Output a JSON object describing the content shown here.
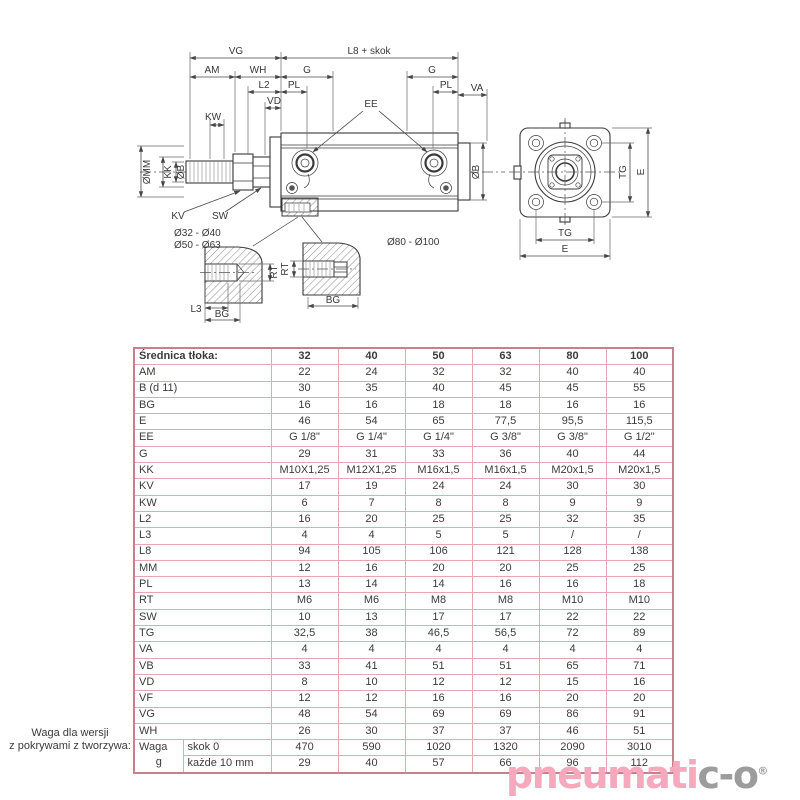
{
  "drawing": {
    "top_dims": {
      "vg": "VG",
      "l8": "L8 + skok",
      "am": "AM",
      "wh": "WH",
      "g_front": "G",
      "g_rear": "G",
      "l2": "L2",
      "pl_front": "PL",
      "pl_rear": "PL",
      "va": "VA",
      "vd": "VD",
      "kw": "KW",
      "ee": "EE"
    },
    "rod_dims": {
      "omm": "ØMM",
      "kk": "KK",
      "ob": "ØB",
      "kv": "KV",
      "sw": "SW"
    },
    "body_dim_ob": "ØB",
    "ranges": {
      "small": "Ø32 - Ø40",
      "mid": "Ø50 - Ø63",
      "large": "Ø80 - Ø100"
    },
    "details": {
      "rt_left": "RT",
      "rt_right": "RT",
      "l3": "L3",
      "bg_left": "BG",
      "bg_right": "BG"
    },
    "end_view": {
      "tg_right": "TG",
      "e_right": "E",
      "tg_bottom": "TG",
      "e_bottom": "E"
    }
  },
  "table": {
    "header_label": "Średnica tłoka:",
    "columns": [
      "32",
      "40",
      "50",
      "63",
      "80",
      "100"
    ],
    "rows": [
      {
        "label": "AM",
        "values": [
          "22",
          "24",
          "32",
          "32",
          "40",
          "40"
        ]
      },
      {
        "label": "B (d 11)",
        "values": [
          "30",
          "35",
          "40",
          "45",
          "45",
          "55"
        ]
      },
      {
        "label": "BG",
        "values": [
          "16",
          "16",
          "18",
          "18",
          "16",
          "16"
        ]
      },
      {
        "label": "E",
        "values": [
          "46",
          "54",
          "65",
          "77,5",
          "95,5",
          "115,5"
        ]
      },
      {
        "label": "EE",
        "values": [
          "G 1/8\"",
          "G 1/4\"",
          "G 1/4\"",
          "G 3/8\"",
          "G 3/8\"",
          "G 1/2\""
        ]
      },
      {
        "label": "G",
        "values": [
          "29",
          "31",
          "33",
          "36",
          "40",
          "44"
        ]
      },
      {
        "label": "KK",
        "values": [
          "M10X1,25",
          "M12X1,25",
          "M16x1,5",
          "M16x1,5",
          "M20x1,5",
          "M20x1,5"
        ]
      },
      {
        "label": "KV",
        "values": [
          "17",
          "19",
          "24",
          "24",
          "30",
          "30"
        ]
      },
      {
        "label": "KW",
        "values": [
          "6",
          "7",
          "8",
          "8",
          "9",
          "9"
        ]
      },
      {
        "label": "L2",
        "values": [
          "16",
          "20",
          "25",
          "25",
          "32",
          "35"
        ]
      },
      {
        "label": "L3",
        "values": [
          "4",
          "4",
          "5",
          "5",
          "/",
          "/"
        ]
      },
      {
        "label": "L8",
        "values": [
          "94",
          "105",
          "106",
          "121",
          "128",
          "138"
        ]
      },
      {
        "label": "MM",
        "values": [
          "12",
          "16",
          "20",
          "20",
          "25",
          "25"
        ]
      },
      {
        "label": "PL",
        "values": [
          "13",
          "14",
          "14",
          "16",
          "16",
          "18"
        ]
      },
      {
        "label": "RT",
        "values": [
          "M6",
          "M6",
          "M8",
          "M8",
          "M10",
          "M10"
        ]
      },
      {
        "label": "SW",
        "values": [
          "10",
          "13",
          "17",
          "17",
          "22",
          "22"
        ]
      },
      {
        "label": "TG",
        "values": [
          "32,5",
          "38",
          "46,5",
          "56,5",
          "72",
          "89"
        ]
      },
      {
        "label": "VA",
        "values": [
          "4",
          "4",
          "4",
          "4",
          "4",
          "4"
        ]
      },
      {
        "label": "VB",
        "values": [
          "33",
          "41",
          "51",
          "51",
          "65",
          "71"
        ]
      },
      {
        "label": "VD",
        "values": [
          "8",
          "10",
          "12",
          "12",
          "15",
          "16"
        ]
      },
      {
        "label": "VF",
        "values": [
          "12",
          "12",
          "16",
          "16",
          "20",
          "20"
        ]
      },
      {
        "label": "VG",
        "values": [
          "48",
          "54",
          "69",
          "69",
          "86",
          "91"
        ]
      },
      {
        "label": "WH",
        "values": [
          "26",
          "30",
          "37",
          "37",
          "46",
          "51"
        ]
      }
    ],
    "waga": {
      "label": "Waga",
      "unit": "g",
      "sub": [
        {
          "label": "skok 0",
          "values": [
            "470",
            "590",
            "1020",
            "1320",
            "2090",
            "3010"
          ]
        },
        {
          "label": "każde 10 mm",
          "values": [
            "29",
            "40",
            "57",
            "66",
            "96",
            "112"
          ]
        }
      ]
    }
  },
  "footnote": {
    "line1": "Waga dla wersji",
    "line2": "z pokrywami z tworzywa:"
  },
  "logo": {
    "pink_text": "pneumati",
    "gray_text": "c-o",
    "registered": "®"
  },
  "colors": {
    "logo_pink": "#f6a9bd",
    "logo_gray": "#9c9c9c",
    "table_border": "#e2a9b3",
    "table_outer_border": "#c8808e"
  }
}
